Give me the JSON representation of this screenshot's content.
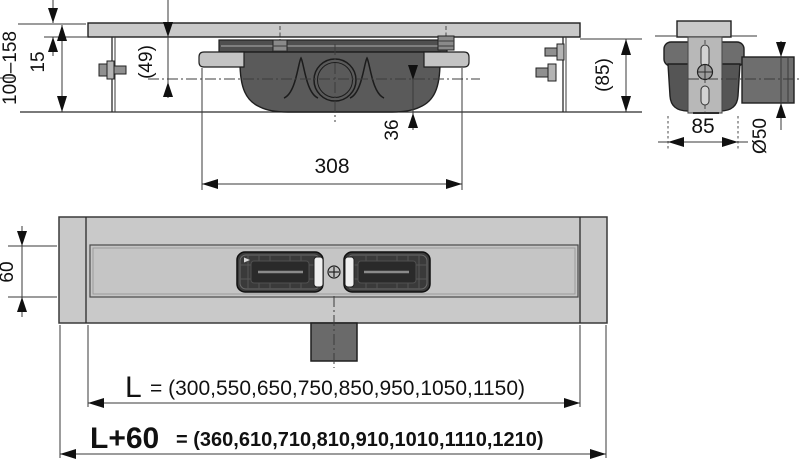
{
  "side_view": {
    "height_range": "100–158",
    "plate_thickness": "15",
    "underside_to_axis": "(49)",
    "axis_to_bottom": "36",
    "body_length": "308",
    "overall_height": "(85)"
  },
  "end_view": {
    "body_width": "85",
    "outlet_diameter": "Ø50"
  },
  "plan_view": {
    "channel_width": "60",
    "length": {
      "label": "L",
      "values": "= (300,550,650,750,850,950,1050,1150)"
    },
    "total_length": {
      "label": "L+60",
      "values": "= (360,610,710,810,910,1010,1110,1210)"
    }
  },
  "colors": {
    "background": "#ffffff",
    "line": "#1f1f1f",
    "fill_light": "#c9c9c9",
    "fill_medium": "#8f8f8f",
    "fill_dark": "#5a5a5a",
    "fill_grate": "#3a3a3a"
  }
}
